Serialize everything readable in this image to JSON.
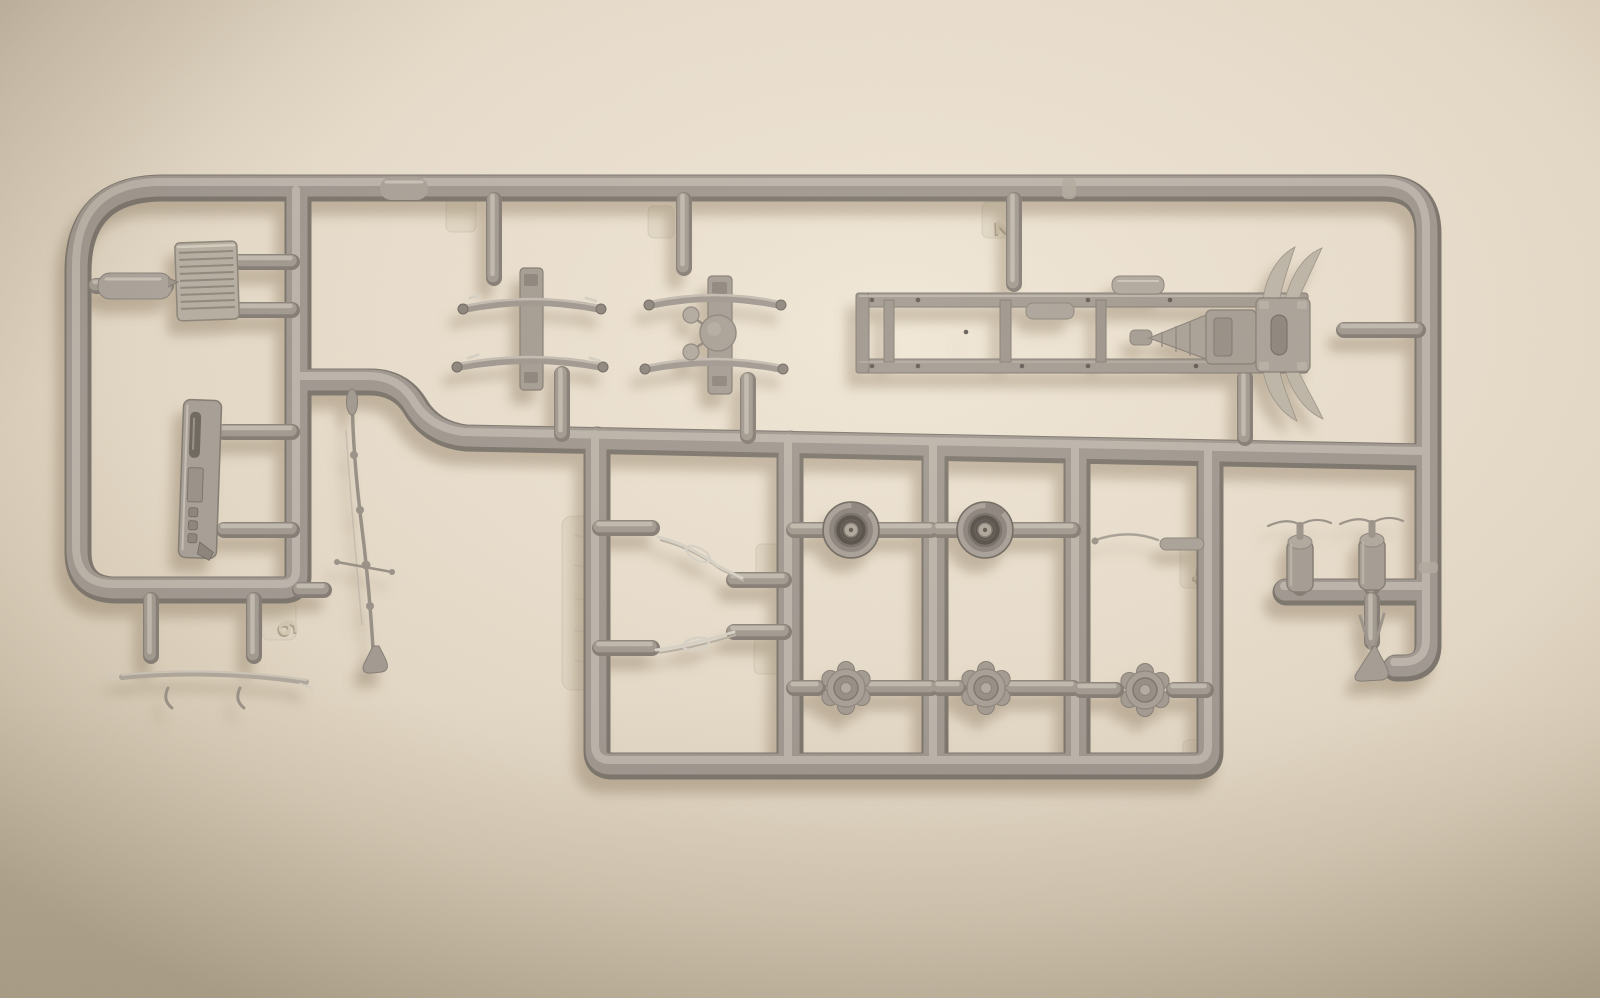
{
  "image": {
    "subject": "Photograph of a grey injection-moulded plastic model kit sprue (parts tree) for a military truck, lying on a cream wall background",
    "type": "photograph",
    "lighting": "warm light from upper right, soft shadows cast down-left"
  },
  "palette": {
    "background_center": "#efe5d4",
    "background_edge": "#cfc3ae",
    "plastic_base": "#a09890",
    "plastic_dark": "#7c756c",
    "plastic_highlight": "#c3bbb0",
    "light_parts": "#d8d2c6",
    "cast_shadow": "#8a7a60"
  },
  "markings": [
    {
      "label": "6"
    },
    {
      "label": "2"
    },
    {
      "label": "4"
    }
  ],
  "parts": [
    {
      "name": "runner-frame",
      "desc": "Grey plastic sprue runner frame with rounded corners and internal runner bars"
    },
    {
      "name": "sprue-gates",
      "desc": "Moulding gates and bullet-shaped feed stubs connecting parts to runners"
    },
    {
      "name": "radiator-grille",
      "desc": "Ribbed radiator grille panel"
    },
    {
      "name": "capsule-part",
      "desc": "Small capsule-shaped part on the left outer runner"
    },
    {
      "name": "slotted-panel",
      "desc": "Flat panel part with slots and recesses"
    },
    {
      "name": "tow-rod",
      "desc": "Long thin rod with ball joints, crossbar and flared foot"
    },
    {
      "name": "leaf-springs-left",
      "desc": "Pair of leaf springs with mounting plate"
    },
    {
      "name": "leaf-springs-right",
      "desc": "Pair of leaf springs with mounting plate and round idler housing"
    },
    {
      "name": "chassis-frame",
      "desc": "Truck ladder chassis frame with crossmembers, transfer case cone and rear mount with curved spring blades"
    },
    {
      "name": "roadwheel",
      "desc": "Roadwheel with recessed dark tyre and light hub"
    },
    {
      "name": "hub-cap",
      "desc": "Scalloped wheel hub cap"
    },
    {
      "name": "linkage",
      "desc": "Light-coloured thin linkage part"
    },
    {
      "name": "thin-rod",
      "desc": "Thin bent rod part"
    },
    {
      "name": "air-tank",
      "desc": "Small cylindrical tank part with fine whisker tips"
    },
    {
      "name": "horn",
      "desc": "Small trumpet-shaped horn part"
    },
    {
      "name": "front-spring-bar",
      "desc": "Long thin leaf spring bar with hooks"
    },
    {
      "name": "ejector-tab",
      "desc": "Flat moulded tab, some with embossed part numbers"
    }
  ]
}
